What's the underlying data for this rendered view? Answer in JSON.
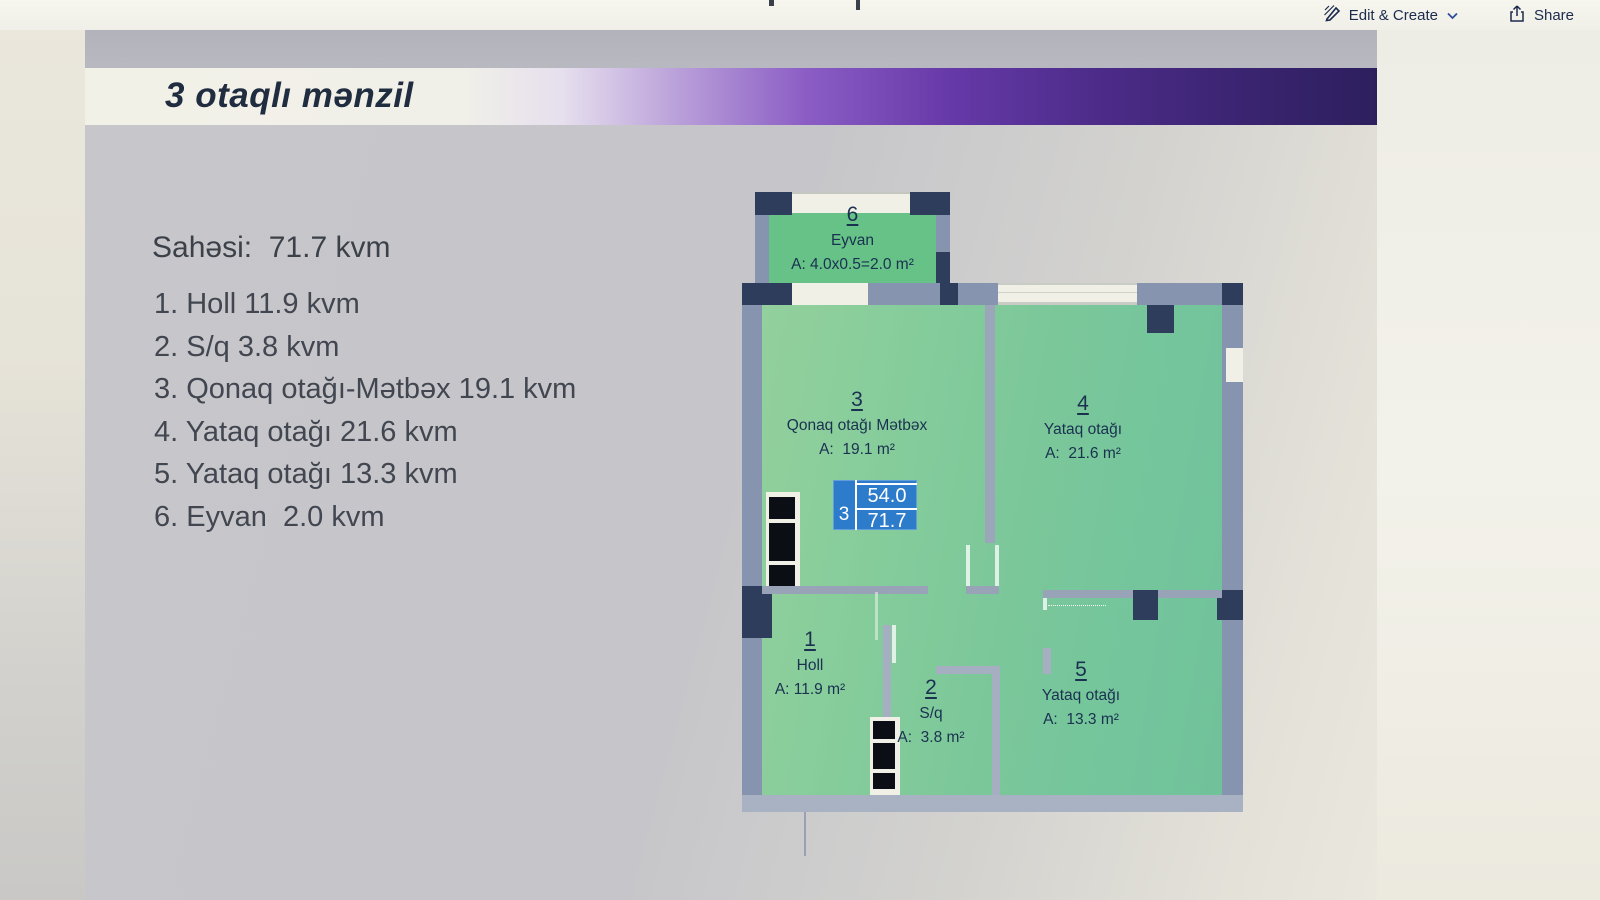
{
  "toolbar": {
    "edit_create_label": "Edit & Create",
    "share_label": "Share"
  },
  "slide": {
    "title": "3 otaqlı mənzil"
  },
  "info": {
    "total": "Sahəsi:  71.7 kvm",
    "items": [
      "1. Holl 11.9 kvm",
      "2. S/q 3.8 kvm",
      "3. Qonaq otağı-Mətbəx 19.1 kvm",
      "4. Yataq otağı 21.6 kvm",
      "5. Yataq otağı 13.3 kvm",
      "6. Eyvan  2.0 kvm"
    ]
  },
  "plan": {
    "rooms": [
      {
        "num": "1",
        "name": "Holl",
        "area": "A: 11.9 m²"
      },
      {
        "num": "2",
        "name": "S/q",
        "area": "A:  3.8 m²"
      },
      {
        "num": "3",
        "name": "Qonaq otağı Mətbəx",
        "area": "A:  19.1 m²"
      },
      {
        "num": "4",
        "name": "Yataq otağı",
        "area": "A:  21.6 m²"
      },
      {
        "num": "5",
        "name": "Yataq otağı",
        "area": "A:  13.3 m²"
      },
      {
        "num": "6",
        "name": "Eyvan",
        "area": "A: 4.0x0.5=2.0 m²"
      }
    ],
    "badge": {
      "floor": "3",
      "area_top": "54.0",
      "area_bottom": "71.7"
    }
  },
  "colors": {
    "badge_blue": "#2c7ccb",
    "purple_bar_dark": "#2d1f5e",
    "purple_bar_mid": "#8a5cc4",
    "title_cream": "#f2f1e8",
    "floor_green": "#7cc795",
    "wall_slate": "#8694af",
    "pillar_navy": "#2e3d5c",
    "label_navy": "#1a3150"
  }
}
